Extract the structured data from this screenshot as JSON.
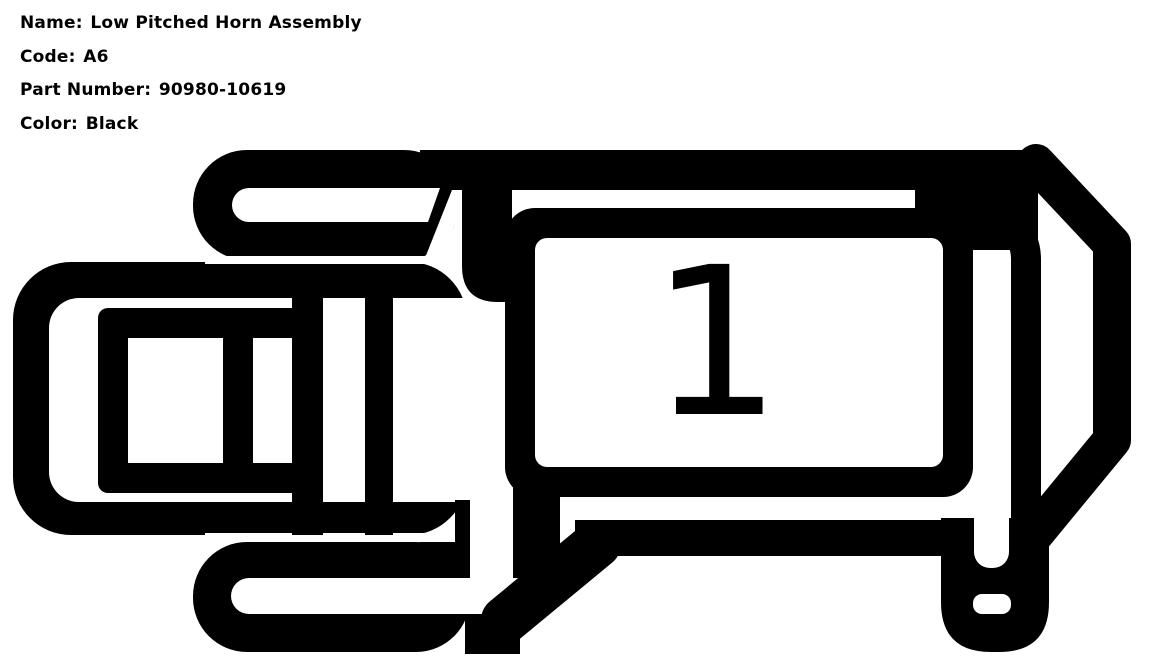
{
  "header": {
    "fields": [
      {
        "label": "Name:",
        "value": "Low Pitched Horn Assembly"
      },
      {
        "label": "Code:",
        "value": "A6"
      },
      {
        "label": "Part Number:",
        "value": "90980-10619"
      },
      {
        "label": "Color:",
        "value": "Black"
      }
    ]
  },
  "diagram": {
    "cavity_label": "1",
    "ink_color": "#000000",
    "background_color": "#ffffff"
  }
}
